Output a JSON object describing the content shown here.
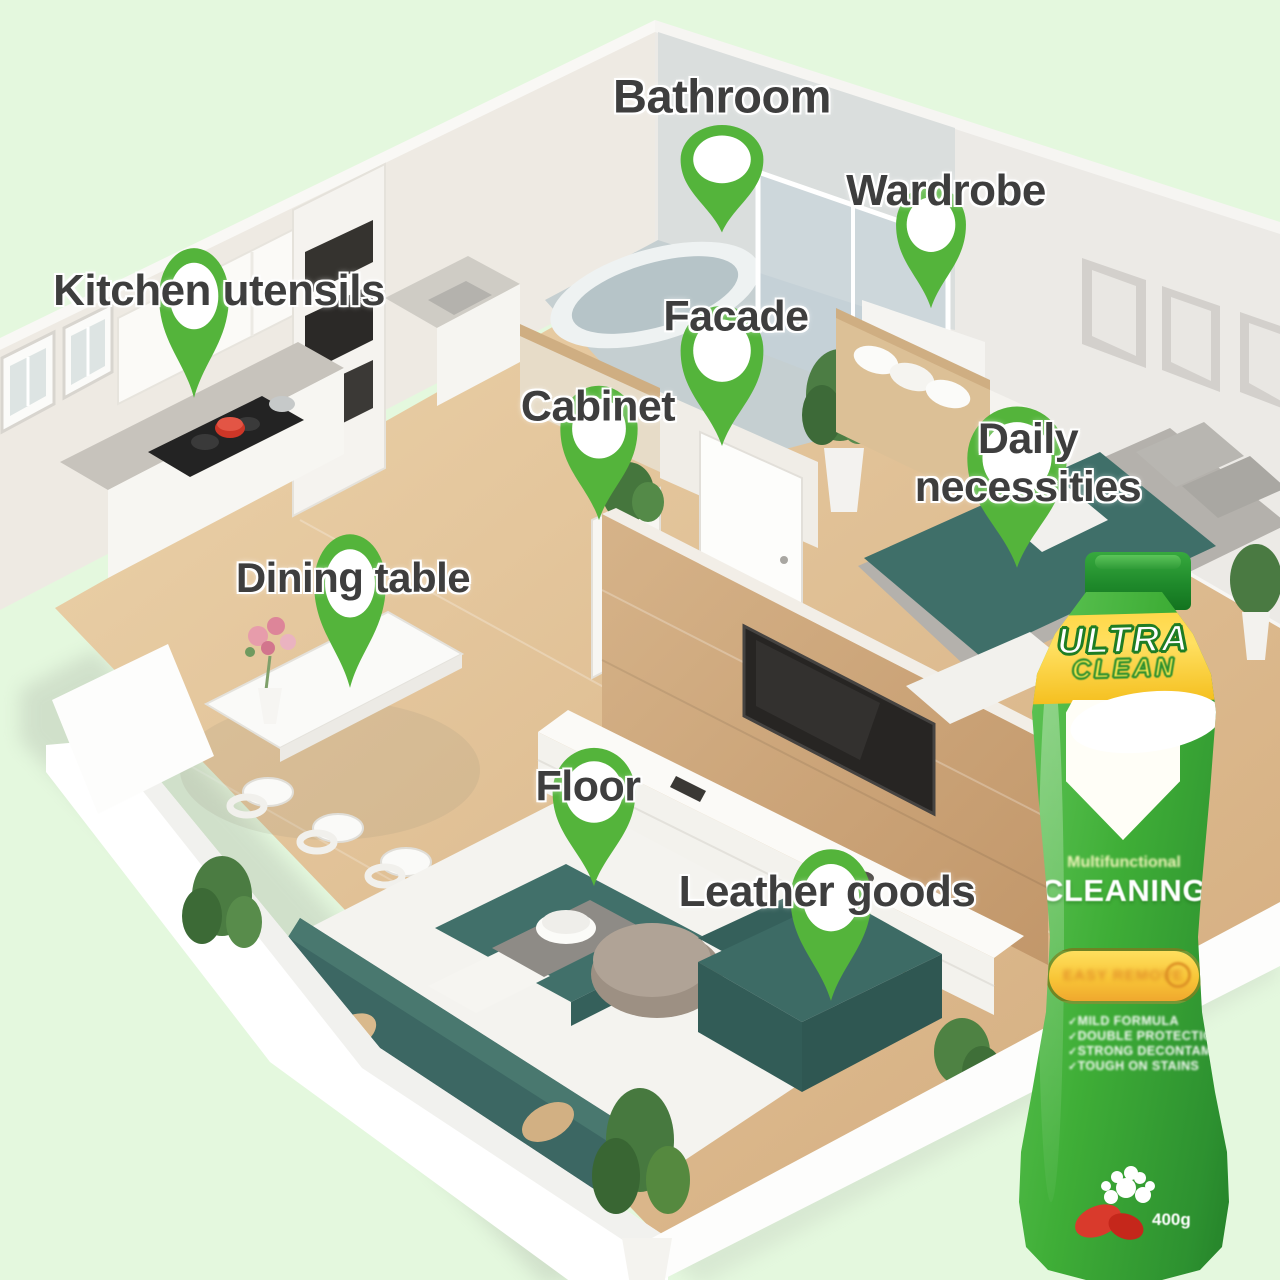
{
  "background_color": "#e4f8de",
  "pin_color": "#54b43b",
  "floor_plan": {
    "description": "3D isometric cutaway apartment with green location pins",
    "labels": [
      "Bathroom",
      "Wardrobe",
      "Kitchen utensils",
      "Facade",
      "Cabinet",
      "Daily necessities",
      "Dining table",
      "Floor",
      "Leather goods"
    ]
  },
  "product": {
    "brand_top": "ULTRA",
    "brand_bottom": "CLEAN",
    "subtitle": "Multifunctional",
    "product_type": "CLEANING",
    "badge_text": "EASY REMOVE",
    "features": [
      "MILD FORMULA",
      "DOUBLE PROTECTION",
      "STRONG DECONTAMINATION",
      "TOUGH ON STAINS"
    ],
    "net_weight": "400g",
    "colors": {
      "body_green": "#3fae37",
      "band_yellow": "#ffd84a",
      "cap_green": "#1f8a2b"
    }
  }
}
